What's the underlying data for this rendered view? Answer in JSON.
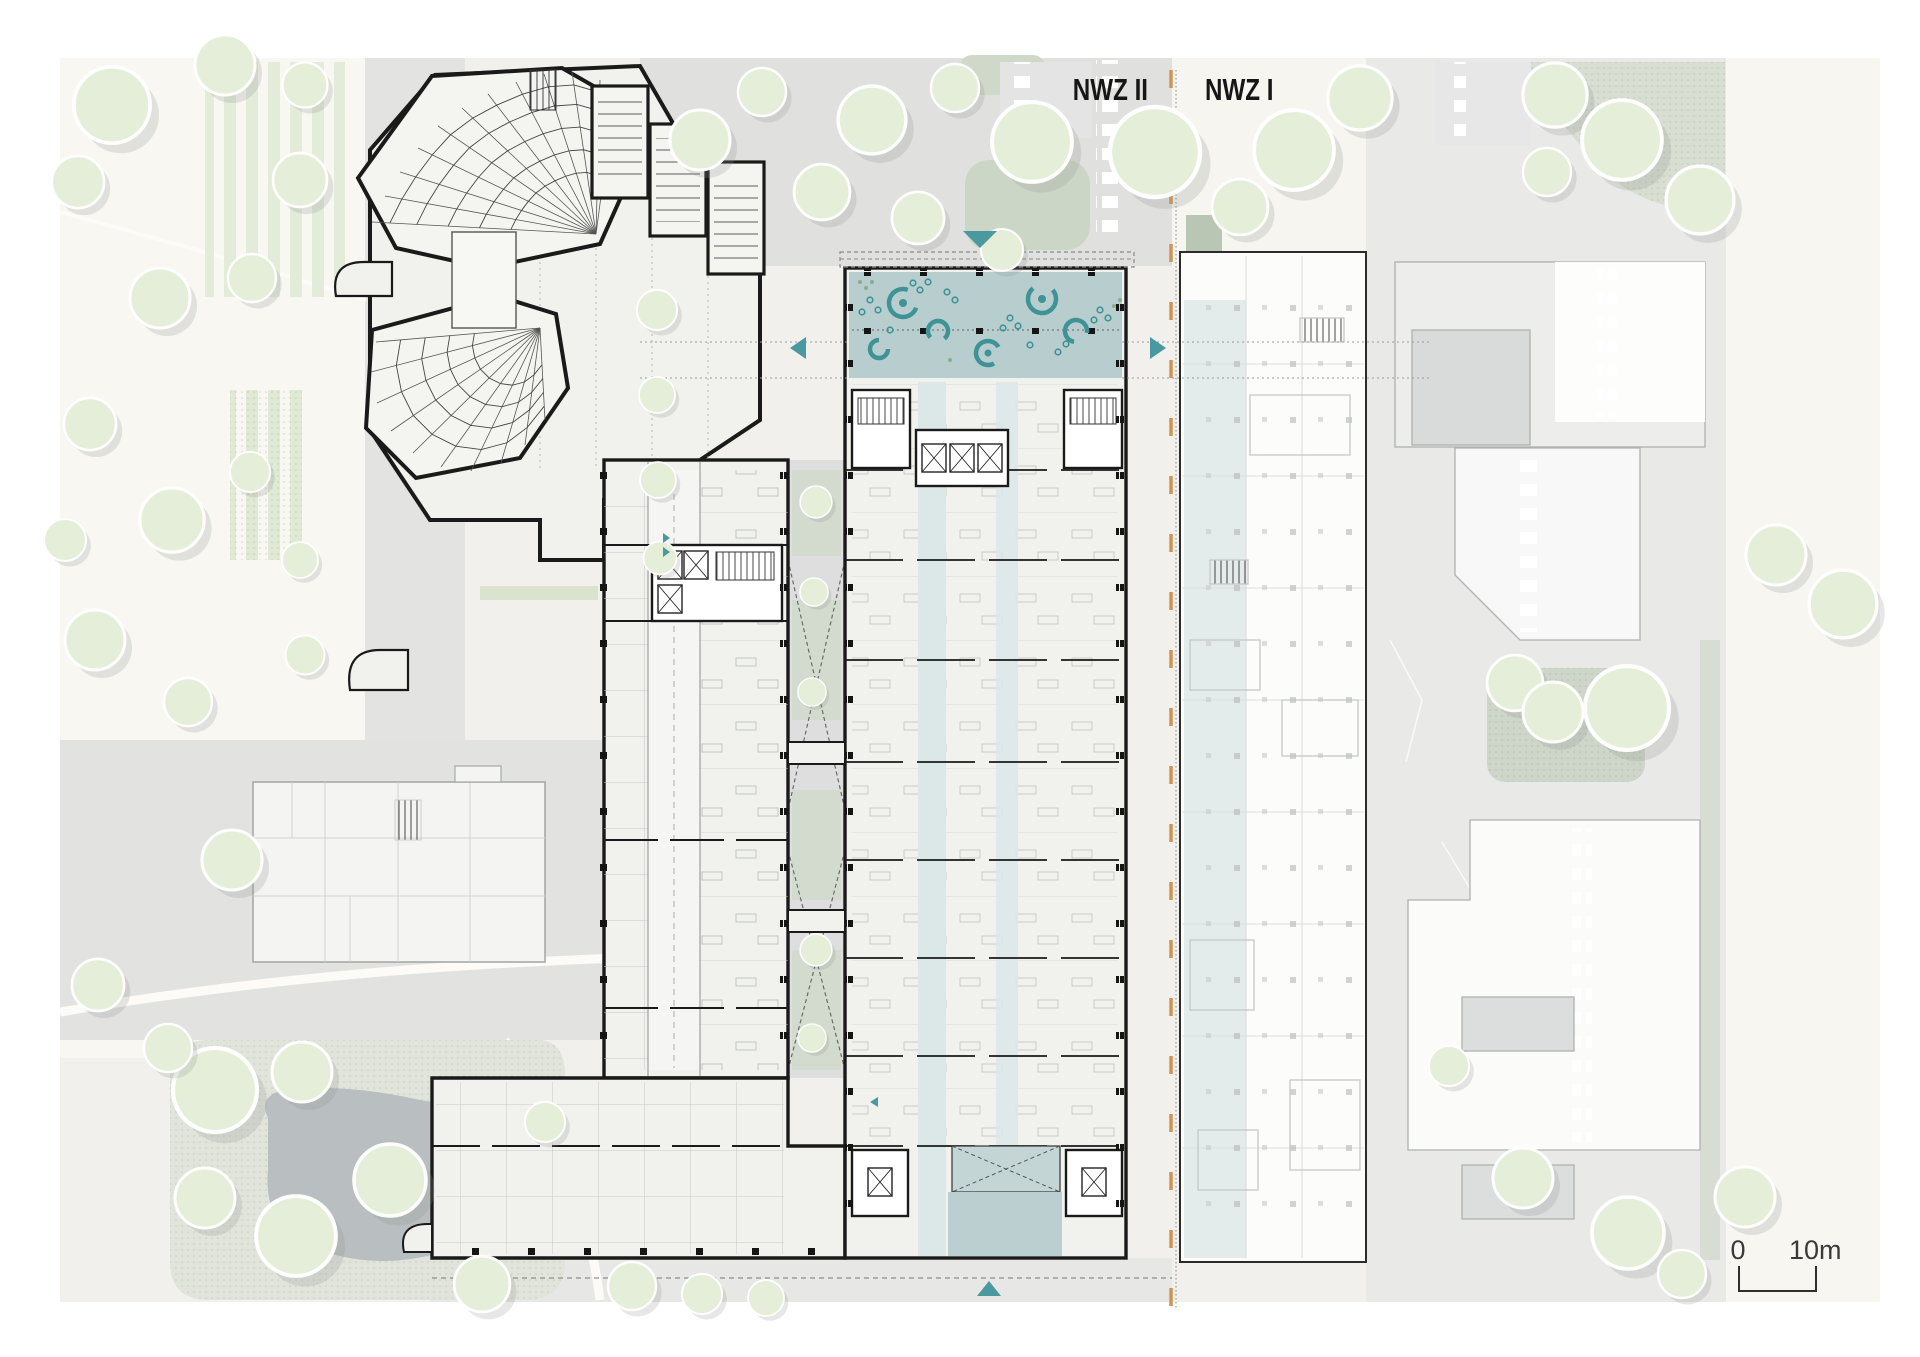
{
  "plan": {
    "title": "Site / floor plan NWZ",
    "labels": {
      "nwz2": "NWZ II",
      "nwz1": "NWZ I"
    },
    "scale_bar": {
      "start_label": "0",
      "end_label": "10m"
    },
    "colors": {
      "accent_teal": "#4a98a0",
      "atrium_fill": "#b7cdce",
      "furniture_teal": "#3f9396",
      "pale_teal_band": "#dce8e7",
      "boundary_orange": "#cf9452",
      "wall_black": "#1a1a1a",
      "tree_green": "#e4eed9",
      "ground_cream": "#f8f7f2",
      "ground_gray": "#e8e9e7"
    },
    "icons": {
      "entrance_arrow_north": "triangle-down",
      "entrance_arrow_south": "triangle-up",
      "entrance_arrow_west": "triangle-left",
      "entrance_arrow_east": "triangle-right"
    }
  }
}
